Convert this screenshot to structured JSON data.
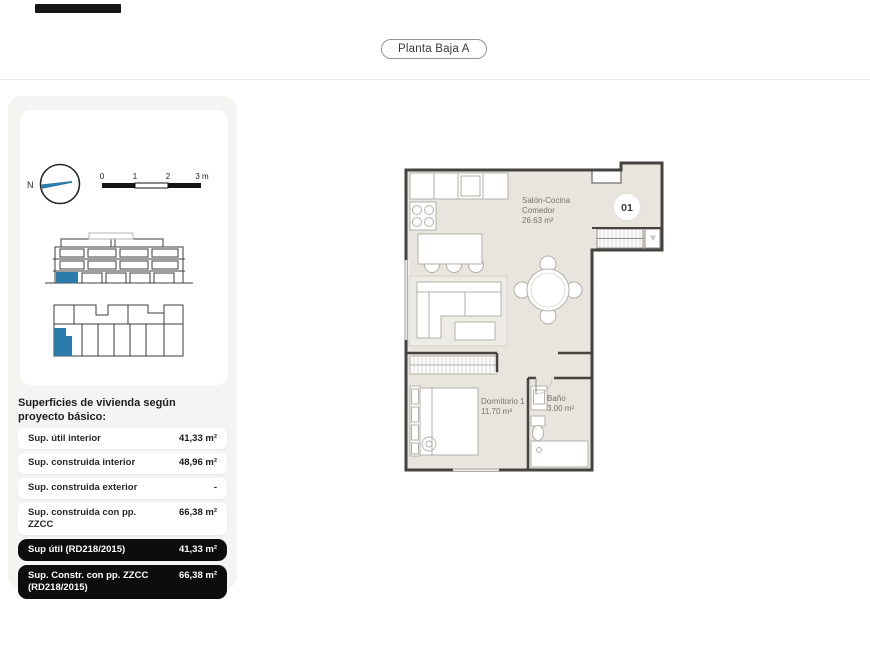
{
  "header": {
    "title_pill": "Planta Baja A"
  },
  "legend": {
    "north_label": "N",
    "scale_ticks": [
      "0",
      "1",
      "2",
      "3 m"
    ]
  },
  "surfaces": {
    "heading": "Superficies de vivienda según proyecto básico:",
    "rows": [
      {
        "label": "Sup. útil interior",
        "value": "41,33 m²",
        "highlight": false
      },
      {
        "label": "Sup. construida interior",
        "value": "48,96 m²",
        "highlight": false
      },
      {
        "label": "Sup. construida exterior",
        "value": "-",
        "highlight": false
      },
      {
        "label": "Sup. construida con pp. ZZCC",
        "value": "66,38 m²",
        "highlight": false
      },
      {
        "label": "Sup útil (RD218/2015)",
        "value": "41,33 m²",
        "highlight": true
      },
      {
        "label": "Sup. Constr. con pp. ZZCC (RD218/2015)",
        "value": "66,38 m²",
        "highlight": true
      }
    ]
  },
  "plan": {
    "unit_badge": "01",
    "rooms": {
      "salon": {
        "line1": "Salón-Cocina",
        "line2": "Comedor",
        "area": "26.63 m²"
      },
      "dormitorio": {
        "name": "Dormitorio 1",
        "area": "11.70 m²"
      },
      "bano": {
        "name": "Baño",
        "area": "3.00 m²"
      }
    }
  },
  "colors": {
    "accent_blue": "#2b7cab",
    "row_highlight_bg": "#0d0d0c",
    "wall": "#45433f",
    "floor_fill": "#e8e5df"
  }
}
